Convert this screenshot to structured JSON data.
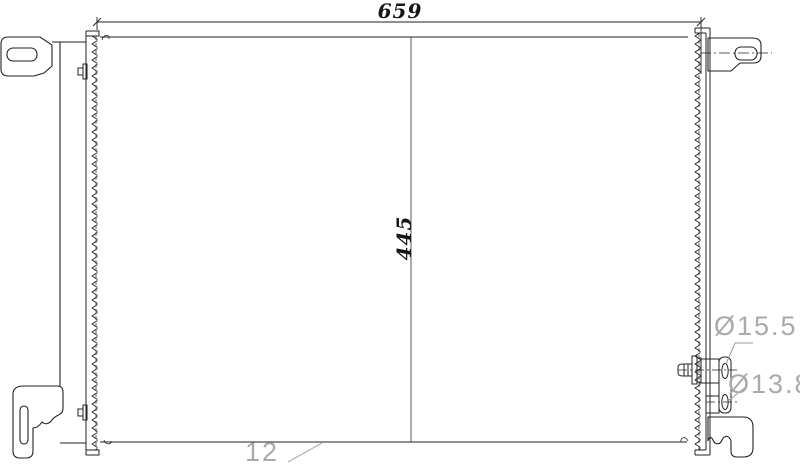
{
  "drawing": {
    "type": "condenser-technical-drawing",
    "dim_width": "659",
    "dim_height": "445",
    "dim_depth": "12",
    "port_top_diameter": "Ø15.5",
    "port_bottom_diameter": "Ø13.8",
    "colors": {
      "background": "#ffffff",
      "line": "#222222",
      "dim_text_dark": "#161616",
      "dim_text_gray": "#aaaaaa",
      "leader_gray": "#9b9b9b"
    }
  }
}
